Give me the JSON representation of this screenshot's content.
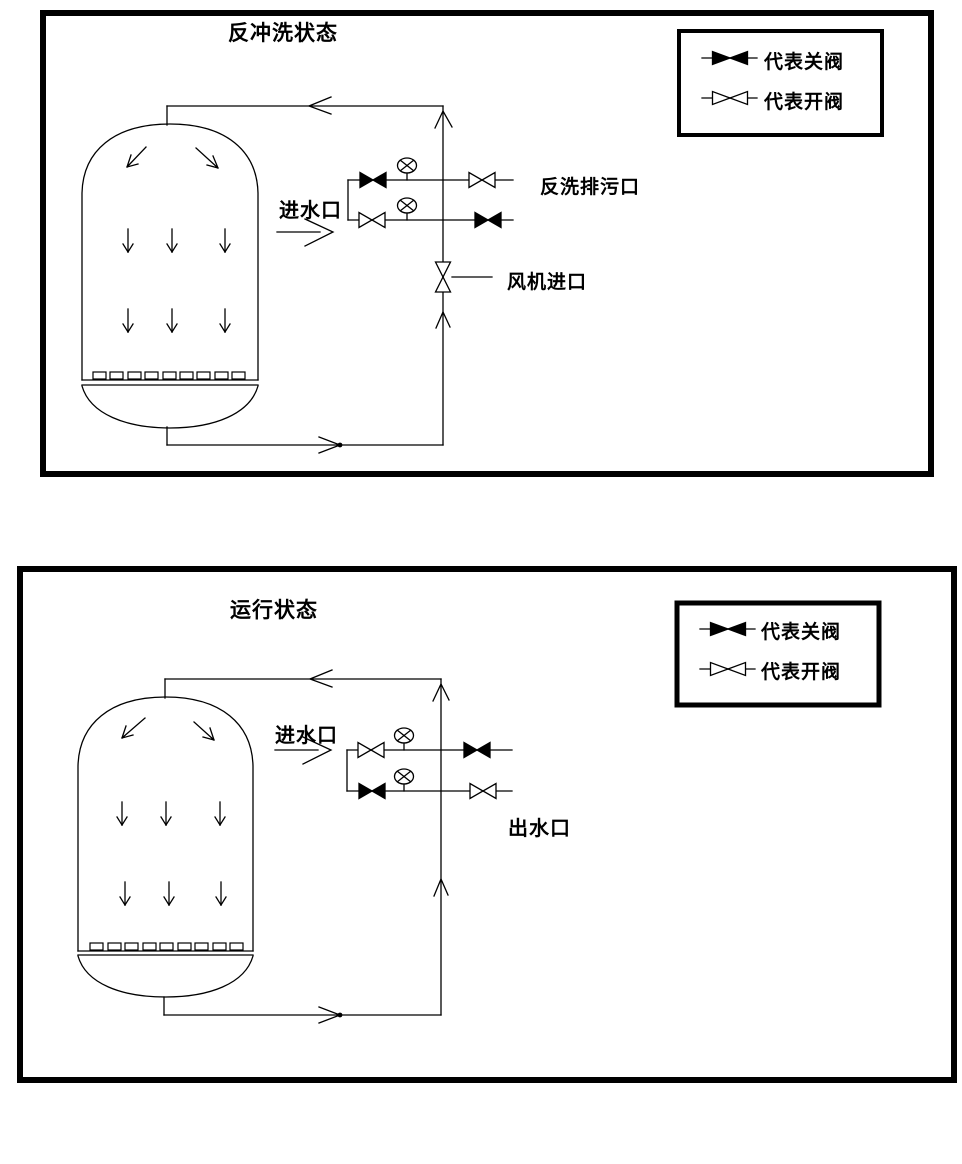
{
  "diagram": {
    "bg_color": "#ffffff",
    "line_color": "#000000",
    "panels": [
      {
        "title": "反冲洗状态",
        "legend": [
          {
            "symbol": "closed-valve",
            "label": "代表关阀"
          },
          {
            "symbol": "open-valve",
            "label": "代表开阀"
          }
        ],
        "labels": {
          "inlet": "进水口",
          "backwash_drain": "反洗排污口",
          "blower_inlet": "风机进口"
        },
        "valve_states": {
          "upper_branch_left": "closed",
          "upper_branch_right": "open",
          "lower_branch_left": "open",
          "lower_branch_right": "closed",
          "blower_line_valve": "open"
        }
      },
      {
        "title": "运行状态",
        "legend": [
          {
            "symbol": "closed-valve",
            "label": "代表关阀"
          },
          {
            "symbol": "open-valve",
            "label": "代表开阀"
          }
        ],
        "labels": {
          "inlet": "进水口",
          "outlet": "出水口"
        },
        "valve_states": {
          "upper_branch_left": "open",
          "upper_branch_right": "closed",
          "lower_branch_left": "closed",
          "lower_branch_right": "open"
        }
      }
    ]
  }
}
